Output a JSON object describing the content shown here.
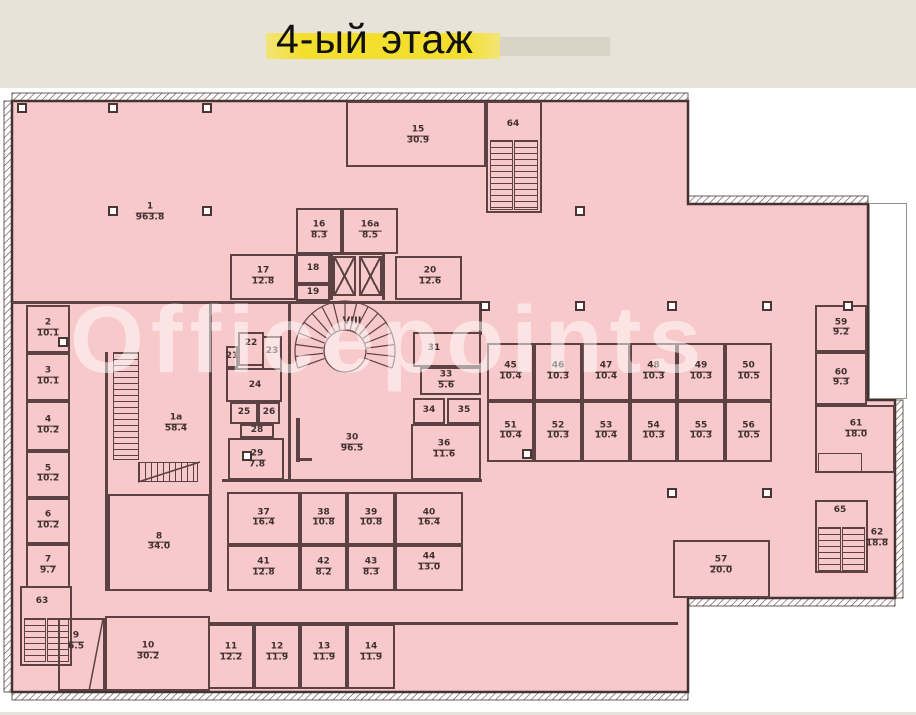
{
  "page": {
    "title": "4-ый этаж",
    "watermark": "Officepoints"
  },
  "colors": {
    "page_bg": "#e7e3d8",
    "sheet": "#ffffff",
    "floor_fill": "#f8c9cb",
    "wall": "#5c4242",
    "exterior_wall": "#453232",
    "label": "#3f2f2f",
    "title_highlight": "#f4df2e",
    "title_highlight2": "#d8d4c6",
    "watermark": "rgba(255,255,255,0.5)"
  },
  "plan": {
    "rooms": [
      {
        "num": "1",
        "area": "963.8",
        "lx": 150,
        "ly": 213
      },
      {
        "num": "1а",
        "area": "58.4",
        "lx": 176,
        "ly": 424
      },
      {
        "num": "2",
        "area": "10.1",
        "rect": [
          26,
          305,
          44,
          48
        ]
      },
      {
        "num": "3",
        "area": "10.1",
        "rect": [
          26,
          353,
          44,
          48
        ]
      },
      {
        "num": "4",
        "area": "10.2",
        "rect": [
          26,
          401,
          44,
          50
        ]
      },
      {
        "num": "5",
        "area": "10.2",
        "rect": [
          26,
          451,
          44,
          47
        ]
      },
      {
        "num": "6",
        "area": "10.2",
        "rect": [
          26,
          498,
          44,
          46
        ]
      },
      {
        "num": "7",
        "area": "9.7",
        "rect": [
          26,
          544,
          44,
          44
        ]
      },
      {
        "num": "8",
        "area": "34.0",
        "rect": [
          108,
          494,
          102,
          97
        ]
      },
      {
        "num": "9",
        "area": "6.5",
        "rect": [
          58,
          618,
          47,
          73
        ],
        "lx": 76,
        "ly": 642
      },
      {
        "num": "10",
        "area": "30.2",
        "rect": [
          105,
          616,
          105,
          75
        ],
        "lx": 148,
        "ly": 652
      },
      {
        "num": "11",
        "area": "12.2",
        "rect": [
          208,
          624,
          46,
          65
        ],
        "lx": 231,
        "ly": 653
      },
      {
        "num": "12",
        "area": "11.9",
        "rect": [
          254,
          624,
          46,
          65
        ],
        "lx": 277,
        "ly": 653
      },
      {
        "num": "13",
        "area": "11.9",
        "rect": [
          300,
          624,
          47,
          65
        ],
        "lx": 324,
        "ly": 653
      },
      {
        "num": "14",
        "area": "11.9",
        "rect": [
          347,
          624,
          48,
          65
        ],
        "lx": 371,
        "ly": 653
      },
      {
        "num": "15",
        "area": "30.9",
        "rect": [
          346,
          101,
          140,
          66
        ],
        "lx": 418,
        "ly": 136
      },
      {
        "num": "16",
        "area": "8.3",
        "rect": [
          296,
          208,
          46,
          46
        ]
      },
      {
        "num": "16а",
        "area": "8.5",
        "rect": [
          342,
          208,
          56,
          46
        ]
      },
      {
        "num": "17",
        "area": "12.8",
        "rect": [
          230,
          254,
          66,
          46
        ]
      },
      {
        "num": "18",
        "rect": [
          296,
          254,
          34,
          30
        ]
      },
      {
        "num": "19",
        "rect": [
          296,
          284,
          34,
          17
        ]
      },
      {
        "num": "20",
        "area": "12.6",
        "rect": [
          395,
          256,
          67,
          44
        ],
        "lx": 430,
        "ly": 277
      },
      {
        "num": "21",
        "rect": [
          226,
          346,
          12,
          22
        ]
      },
      {
        "num": "22",
        "rect": [
          238,
          332,
          26,
          34
        ],
        "lx": 251,
        "ly": 344
      },
      {
        "num": "23",
        "rect": [
          262,
          336,
          20,
          34
        ],
        "lx": 272,
        "ly": 352
      },
      {
        "num": "24",
        "rect": [
          226,
          368,
          56,
          34
        ],
        "lx": 255,
        "ly": 386
      },
      {
        "num": "25",
        "rect": [
          230,
          402,
          28,
          22
        ]
      },
      {
        "num": "26",
        "rect": [
          258,
          402,
          22,
          22
        ]
      },
      {
        "num": "28",
        "rect": [
          240,
          424,
          34,
          14
        ]
      },
      {
        "num": "29",
        "area": "7.8",
        "rect": [
          228,
          438,
          56,
          42
        ],
        "lx": 257,
        "ly": 460
      },
      {
        "num": "30",
        "area": "96.5",
        "lx": 352,
        "ly": 444
      },
      {
        "num": "31",
        "rect": [
          413,
          332,
          68,
          35
        ],
        "lx": 434,
        "ly": 349
      },
      {
        "num": "33",
        "area": "5.6",
        "rect": [
          420,
          367,
          61,
          28
        ],
        "lx": 446,
        "ly": 381
      },
      {
        "num": "34",
        "rect": [
          413,
          398,
          32,
          26
        ]
      },
      {
        "num": "35",
        "rect": [
          447,
          398,
          34,
          26
        ]
      },
      {
        "num": "36",
        "area": "11.6",
        "rect": [
          411,
          424,
          70,
          56
        ],
        "lx": 444,
        "ly": 450
      },
      {
        "num": "37",
        "area": "16.4",
        "rect": [
          227,
          492,
          73,
          53
        ]
      },
      {
        "num": "38",
        "area": "10.8",
        "rect": [
          300,
          492,
          47,
          53
        ]
      },
      {
        "num": "39",
        "area": "10.8",
        "rect": [
          347,
          492,
          48,
          53
        ]
      },
      {
        "num": "40",
        "area": "16.4",
        "rect": [
          395,
          492,
          68,
          53
        ]
      },
      {
        "num": "41",
        "area": "12.8",
        "rect": [
          227,
          545,
          73,
          46
        ]
      },
      {
        "num": "42",
        "area": "8.2",
        "rect": [
          300,
          545,
          47,
          46
        ]
      },
      {
        "num": "43",
        "area": "8.3",
        "rect": [
          347,
          545,
          48,
          46
        ]
      },
      {
        "num": "44",
        "area": "13.0",
        "rect": [
          395,
          545,
          68,
          46
        ],
        "lx": 429,
        "ly": 563
      },
      {
        "num": "45",
        "area": "10.4",
        "rect": [
          487,
          343,
          47,
          58
        ]
      },
      {
        "num": "46",
        "area": "10.3",
        "rect": [
          534,
          343,
          48,
          58
        ]
      },
      {
        "num": "47",
        "area": "10.4",
        "rect": [
          582,
          343,
          48,
          58
        ]
      },
      {
        "num": "48",
        "area": "10.3",
        "rect": [
          630,
          343,
          47,
          58
        ]
      },
      {
        "num": "49",
        "area": "10.3",
        "rect": [
          677,
          343,
          48,
          58
        ]
      },
      {
        "num": "50",
        "area": "10.5",
        "rect": [
          725,
          343,
          47,
          58
        ]
      },
      {
        "num": "51",
        "area": "10.4",
        "rect": [
          487,
          401,
          47,
          61
        ]
      },
      {
        "num": "52",
        "area": "10.3",
        "rect": [
          534,
          401,
          48,
          61
        ]
      },
      {
        "num": "53",
        "area": "10.4",
        "rect": [
          582,
          401,
          48,
          61
        ]
      },
      {
        "num": "54",
        "area": "10.3",
        "rect": [
          630,
          401,
          47,
          61
        ]
      },
      {
        "num": "55",
        "area": "10.3",
        "rect": [
          677,
          401,
          48,
          61
        ]
      },
      {
        "num": "56",
        "area": "10.5",
        "rect": [
          725,
          401,
          47,
          61
        ]
      },
      {
        "num": "57",
        "area": "20.0",
        "rect": [
          673,
          540,
          97,
          58
        ],
        "lx": 721,
        "ly": 566
      },
      {
        "num": "59",
        "area": "9.2",
        "rect": [
          815,
          305,
          52,
          47
        ]
      },
      {
        "num": "60",
        "area": "9.3",
        "rect": [
          815,
          352,
          52,
          53
        ]
      },
      {
        "num": "61",
        "area": "18.0",
        "rect": [
          815,
          405,
          80,
          68
        ],
        "lx": 856,
        "ly": 430
      },
      {
        "num": "62",
        "area": "18.8",
        "lx": 877,
        "ly": 539
      },
      {
        "num": "63",
        "rect": [
          20,
          586,
          52,
          80
        ],
        "lx": 42,
        "ly": 602
      },
      {
        "num": "64",
        "rect": [
          486,
          101,
          56,
          112
        ],
        "lx": 513,
        "ly": 125
      },
      {
        "num": "65",
        "rect": [
          815,
          500,
          53,
          73
        ],
        "lx": 840,
        "ly": 511
      }
    ],
    "special_labels": [
      {
        "text": "VIII",
        "x": 352,
        "y": 321
      },
      {
        "text": "66",
        "x": 345,
        "y": 352
      }
    ],
    "walls": [
      [
        12,
        301,
        468,
        3
      ],
      [
        209,
        303,
        3,
        289
      ],
      [
        105,
        352,
        3,
        239
      ],
      [
        288,
        301,
        3,
        181
      ],
      [
        222,
        479,
        260,
        3
      ],
      [
        479,
        301,
        3,
        34
      ],
      [
        208,
        622,
        470,
        3
      ],
      [
        296,
        418,
        4,
        44
      ],
      [
        296,
        458,
        16,
        3
      ],
      [
        330,
        252,
        3,
        48
      ],
      [
        382,
        252,
        3,
        48
      ],
      [
        330,
        252,
        55,
        3
      ]
    ],
    "columns": [
      [
        22,
        108
      ],
      [
        113,
        108
      ],
      [
        207,
        108
      ],
      [
        113,
        211
      ],
      [
        207,
        211
      ],
      [
        580,
        211
      ],
      [
        485,
        306
      ],
      [
        580,
        306
      ],
      [
        672,
        306
      ],
      [
        767,
        306
      ],
      [
        848,
        306
      ],
      [
        63,
        342
      ],
      [
        247,
        456
      ],
      [
        527,
        454
      ],
      [
        672,
        493
      ],
      [
        767,
        493
      ]
    ],
    "stairs": [
      {
        "rect": [
          490,
          140,
          23,
          70
        ],
        "dir": "h"
      },
      {
        "rect": [
          514,
          140,
          24,
          70
        ],
        "dir": "h"
      },
      {
        "rect": [
          24,
          618,
          22,
          44
        ],
        "dir": "h"
      },
      {
        "rect": [
          47,
          618,
          22,
          44
        ],
        "dir": "h"
      },
      {
        "rect": [
          818,
          527,
          23,
          44
        ],
        "dir": "h"
      },
      {
        "rect": [
          842,
          527,
          23,
          44
        ],
        "dir": "h"
      },
      {
        "rect": [
          113,
          352,
          26,
          108
        ],
        "dir": "h"
      },
      {
        "rect": [
          138,
          462,
          60,
          20
        ],
        "dir": "v"
      },
      {
        "rect": [
          818,
          453,
          44,
          19
        ],
        "dir": "none"
      }
    ],
    "elevators": [
      [
        333,
        256,
        23,
        40
      ],
      [
        359,
        256,
        23,
        40
      ]
    ],
    "terrace": [
      869,
      203,
      38,
      196
    ]
  }
}
